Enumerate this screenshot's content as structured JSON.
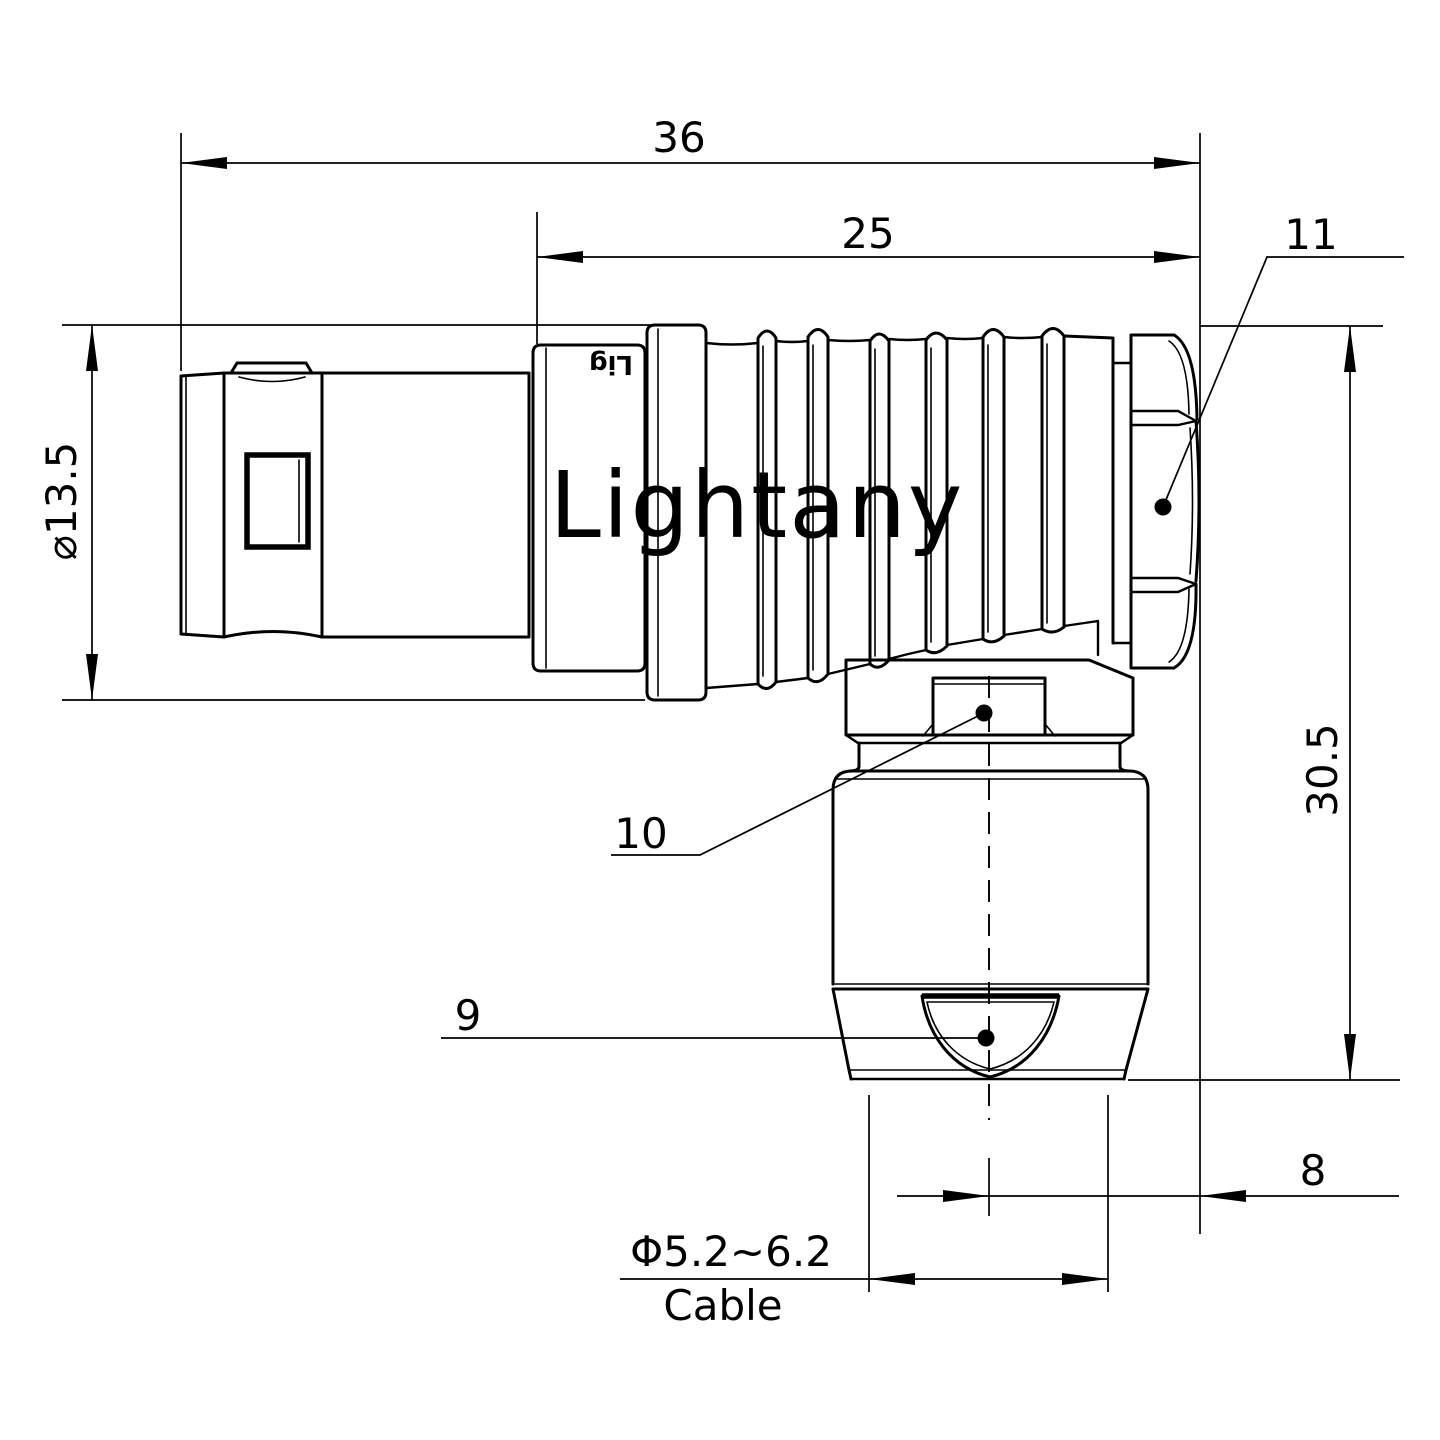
{
  "drawing": {
    "watermark": "Lightany",
    "molded_logo": "Lig",
    "colors": {
      "line": "#000000",
      "watermark": "#f8d8d8",
      "background": "#ffffff"
    },
    "dimensions": {
      "overall_length": "36",
      "rear_length": "25",
      "plug_diameter": "⌀13.5",
      "overall_height": "30.5",
      "stem_offset": "8",
      "cable_range": "Φ5.2~6.2",
      "cable_label": "Cable"
    },
    "callouts": {
      "clamp_nut": "9",
      "hex_nut": "10",
      "back_nut": "11"
    }
  }
}
